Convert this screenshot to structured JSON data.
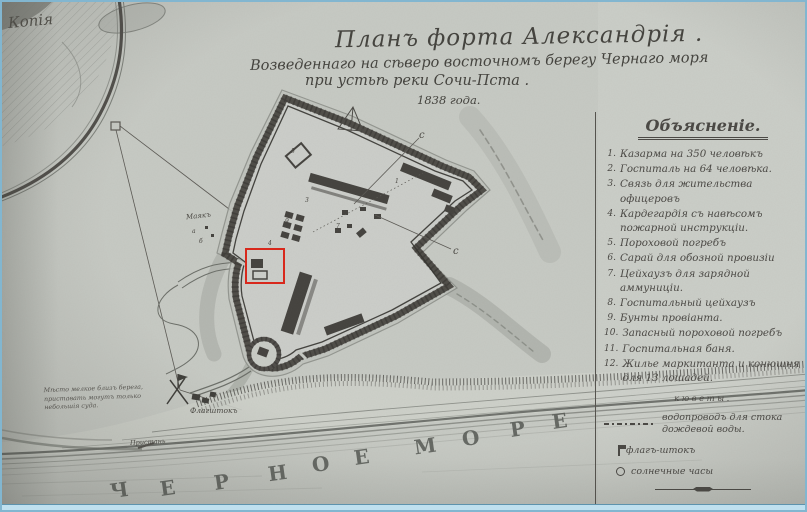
{
  "corner_label": "Копія",
  "title": {
    "line1": "Планъ форта Александрія .",
    "line2": "Возведеннаго на сѣверо восточномъ берегу Чернаго моря",
    "line3": "при устьѣ реки Сочи-Пста .",
    "line4": "1838 года."
  },
  "legend": {
    "heading": "Объясненіе.",
    "items": [
      {
        "num": "1.",
        "text": "Казарма на 350 человѣкъ"
      },
      {
        "num": "2.",
        "text": "Госпиталь на 64 человѣка."
      },
      {
        "num": "3.",
        "text": "Связь для жительства офицеровъ"
      },
      {
        "num": "4.",
        "text": "Кардегардія съ навѣсомъ пожарной инструкціи."
      },
      {
        "num": "5.",
        "text": "Пороховой погребъ"
      },
      {
        "num": "6.",
        "text": "Сарай для обозной провизіи"
      },
      {
        "num": "7.",
        "text": "Цейхаузъ для зарядной аммуниціи."
      },
      {
        "num": "8.",
        "text": "Госпитальный цейхаузъ"
      },
      {
        "num": "9.",
        "text": "Бунты провіанта."
      },
      {
        "num": "10.",
        "text": "Запасный пороховой погребъ"
      },
      {
        "num": "11.",
        "text": "Госпитальная баня."
      },
      {
        "num": "12.",
        "text": "Жилье маркитанта и конюшня для 13 лошадей."
      }
    ],
    "notes_heading": "кюветы.",
    "water_note": "водопроводъ для стока дождевой воды.",
    "flag_note": "флагъ-штокъ",
    "sun_note": "солнечные часы"
  },
  "sea": {
    "name": "ЧЕРНОЕ МОРЕ",
    "letters": [
      "Ч",
      "Е",
      "Р",
      "Н",
      "О",
      "Е",
      "М",
      "О",
      "Р",
      "Е"
    ]
  },
  "map_labels": {
    "west_label": "Маякъ",
    "flagstaff_label": "Флагштокъ",
    "pier_label": "Пристань",
    "shore_note": [
      "Мѣсто мелкое близъ берега,",
      "приставать могутъ только",
      "небольшія суда."
    ],
    "marker_c1": "с",
    "marker_c2": "с",
    "digits": [
      "1",
      "2",
      "3",
      "4",
      "5",
      "7",
      "9",
      "а",
      "б"
    ]
  },
  "annotation": {
    "highlight_color": "#d8281c"
  }
}
